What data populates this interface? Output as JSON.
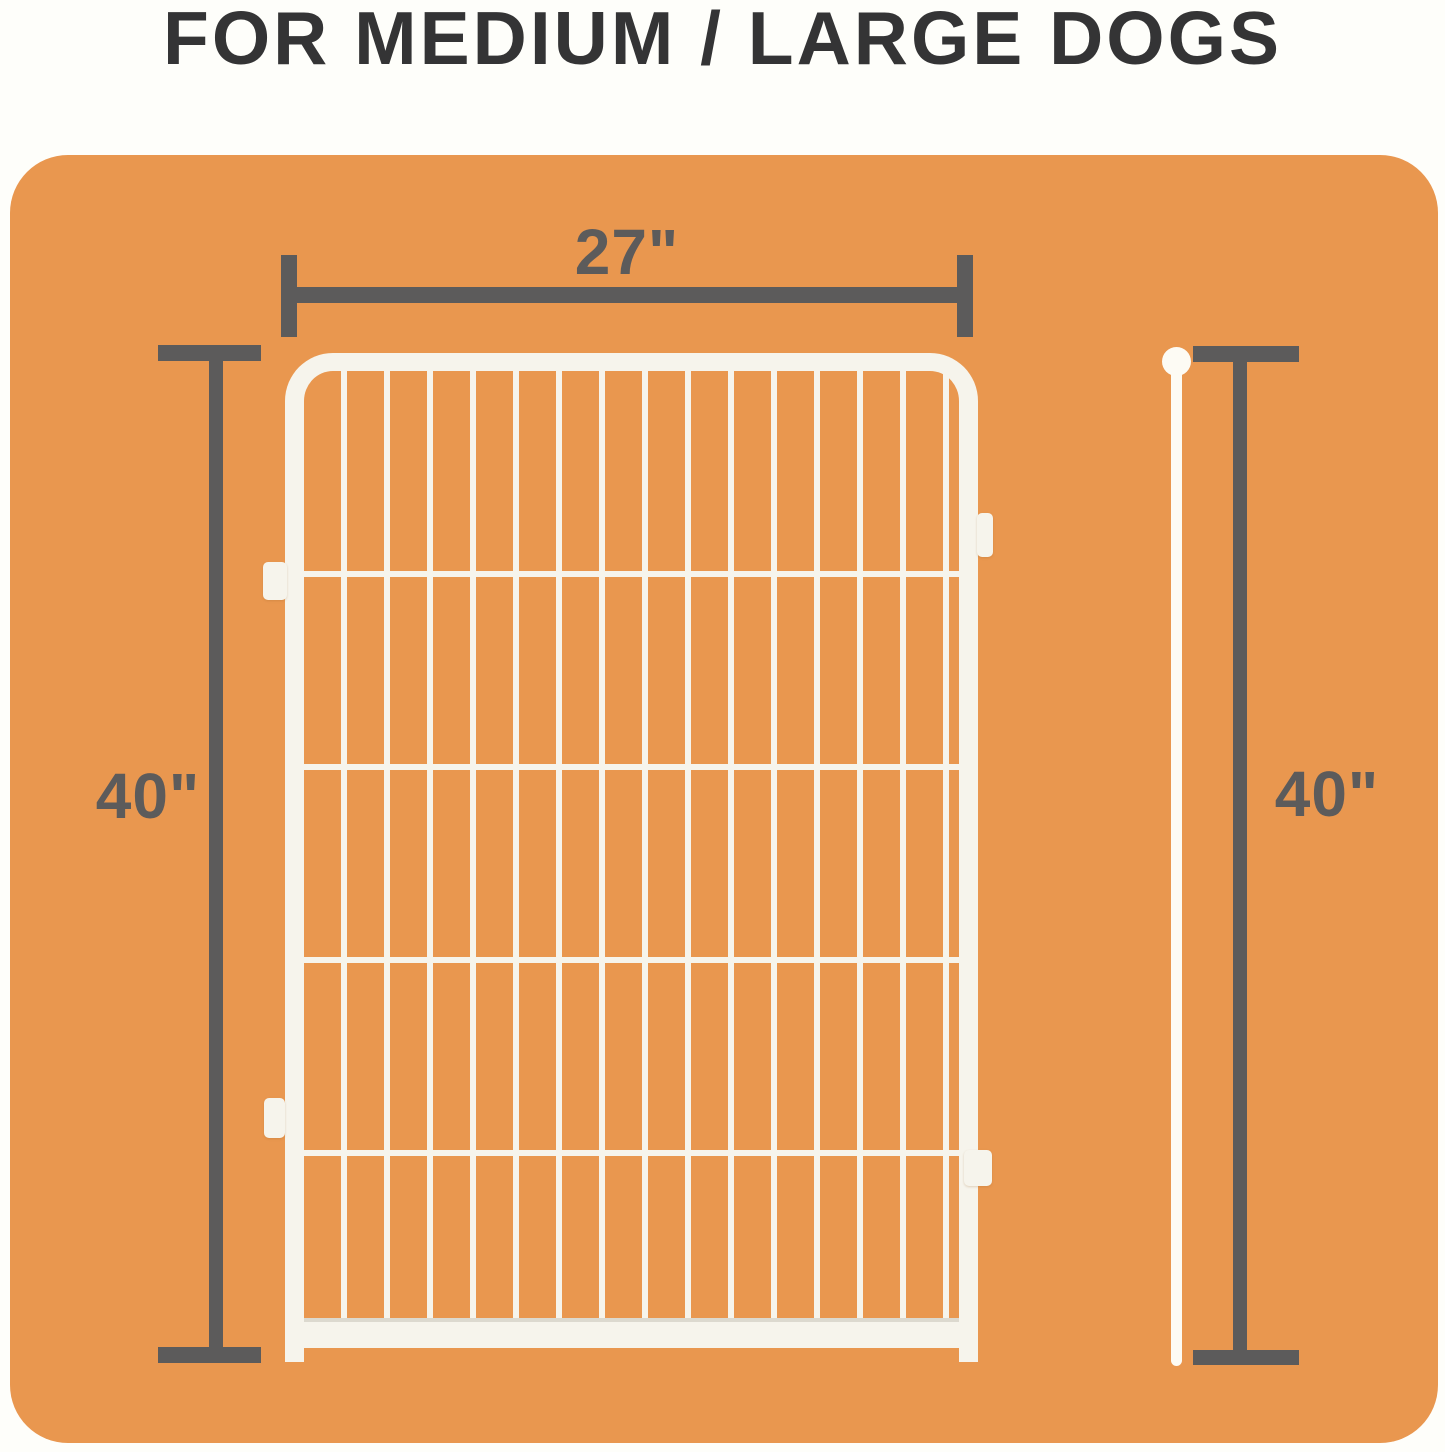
{
  "title": "FOR MEDIUM / LARGE DOGS",
  "dimensions": {
    "width": {
      "label": "27\""
    },
    "height_left": {
      "label": "40\""
    },
    "height_right": {
      "label": "40\""
    }
  },
  "colors": {
    "page-bg": "#FEFEFA",
    "panel-orange": "#E9974F",
    "title-color": "#343435",
    "dim-gray": "#5C5B5B",
    "fence-white": "#F6F4EC",
    "pin-white": "#FDFBF4",
    "rail-shadow": "#DCD9CF"
  }
}
